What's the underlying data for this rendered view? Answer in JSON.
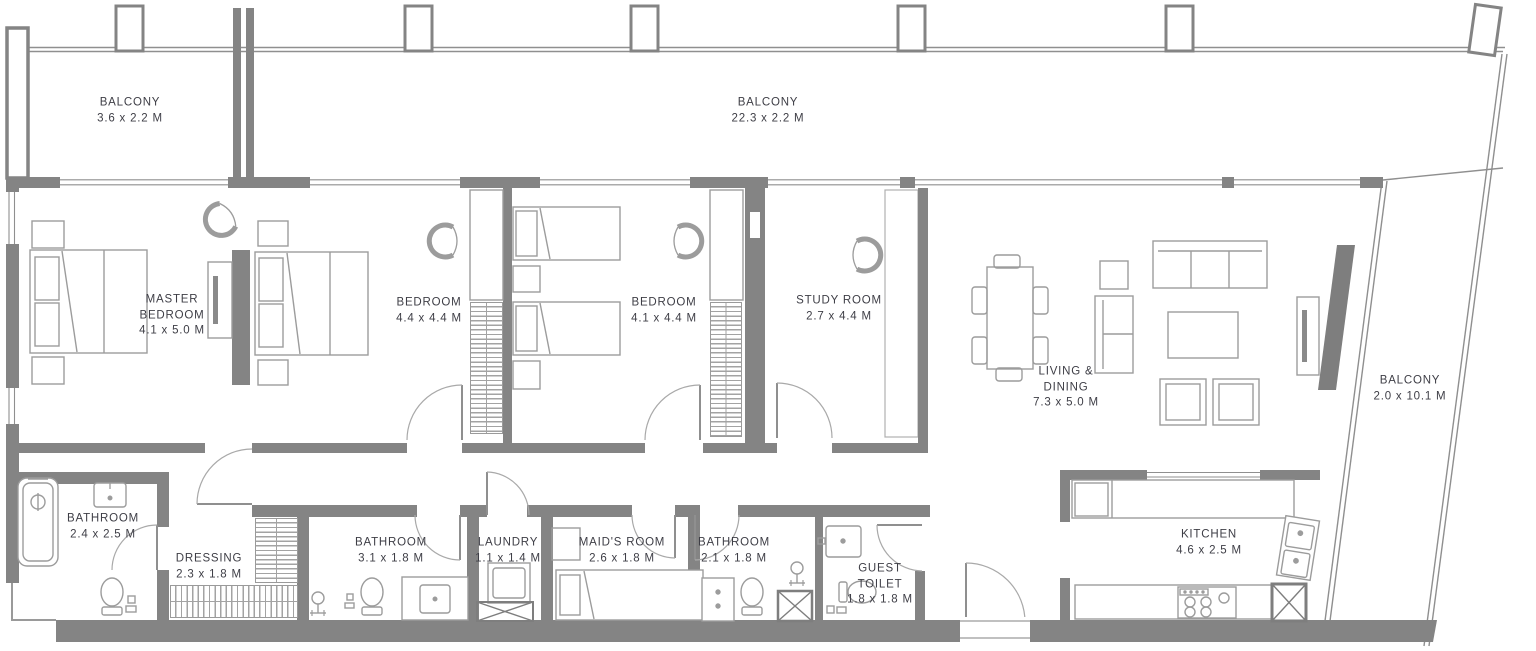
{
  "plan": {
    "type": "apartment-floor-plan",
    "colors": {
      "wall": "#848484",
      "furniture_line": "#9c9c9c",
      "text": "#3e3e46",
      "background": "#ffffff"
    },
    "rooms": [
      {
        "id": "balcony-top-left",
        "name": "BALCONY",
        "dims": "3.6 x 2.2 M"
      },
      {
        "id": "balcony-top-center",
        "name": "BALCONY",
        "dims": "22.3 x 2.2 M"
      },
      {
        "id": "master-bedroom",
        "name": "MASTER BEDROOM",
        "dims": "4.1 x 5.0 M"
      },
      {
        "id": "bedroom-1",
        "name": "BEDROOM",
        "dims": "4.4 x 4.4 M"
      },
      {
        "id": "bedroom-2",
        "name": "BEDROOM",
        "dims": "4.1 x 4.4 M"
      },
      {
        "id": "study-room",
        "name": "STUDY ROOM",
        "dims": "2.7 x 4.4 M"
      },
      {
        "id": "living-dining",
        "name": "LIVING & DINING",
        "dims": "7.3 x 5.0 M"
      },
      {
        "id": "balcony-right",
        "name": "BALCONY",
        "dims": "2.0 x 10.1 M"
      },
      {
        "id": "bathroom-master",
        "name": "BATHROOM",
        "dims": "2.4 x 2.5 M"
      },
      {
        "id": "dressing",
        "name": "DRESSING",
        "dims": "2.3 x 1.8 M"
      },
      {
        "id": "bathroom-2",
        "name": "BATHROOM",
        "dims": "3.1 x 1.8 M"
      },
      {
        "id": "laundry",
        "name": "LAUNDRY",
        "dims": "1.1 x 1.4 M"
      },
      {
        "id": "maids-room",
        "name": "MAID'S ROOM",
        "dims": "2.6 x 1.8 M"
      },
      {
        "id": "bathroom-3",
        "name": "BATHROOM",
        "dims": "2.1 x 1.8 M"
      },
      {
        "id": "guest-toilet",
        "name": "GUEST TOILET",
        "dims": "1.8 x 1.8 M"
      },
      {
        "id": "kitchen",
        "name": "KITCHEN",
        "dims": "4.6 x 2.5 M"
      }
    ]
  }
}
